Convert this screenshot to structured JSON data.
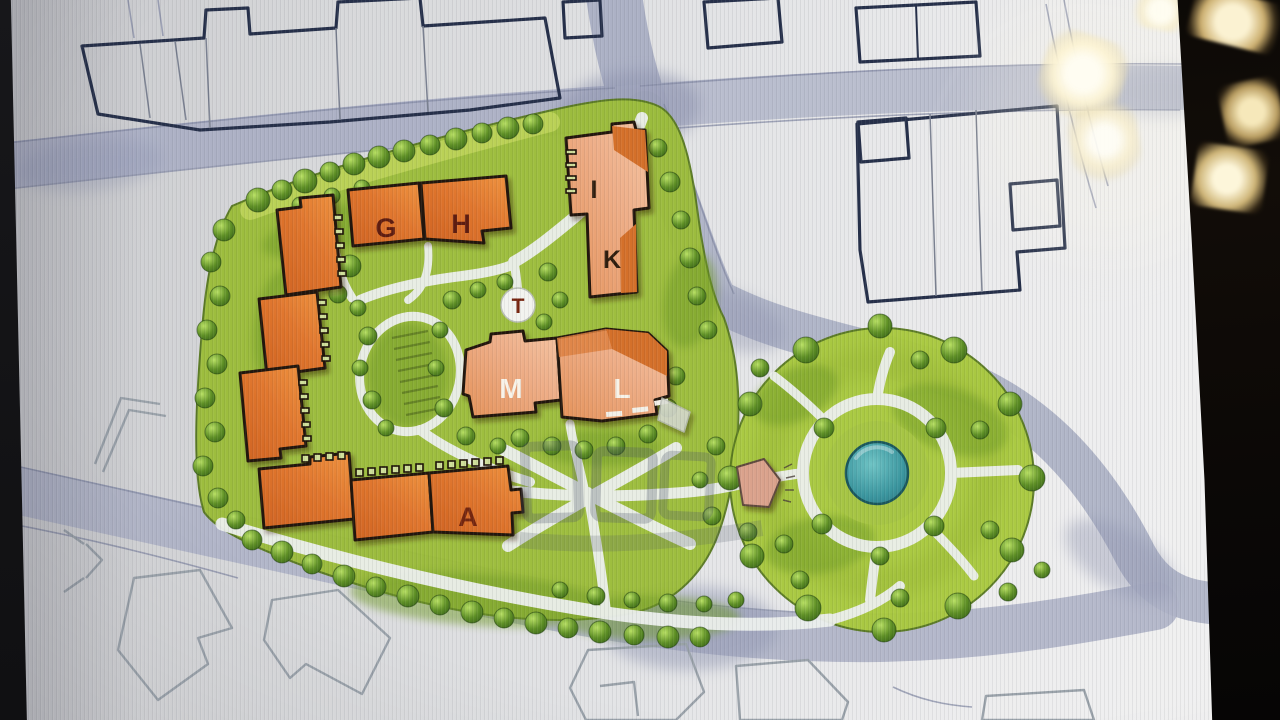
{
  "site_plan": {
    "building_labels": [
      {
        "id": "g",
        "label": "G",
        "color": "#5f1d10"
      },
      {
        "id": "h",
        "label": "H",
        "color": "#5f1d10"
      },
      {
        "id": "i",
        "label": "I",
        "color": "#2e1d0e"
      },
      {
        "id": "k",
        "label": "K",
        "color": "#2e1d0e"
      },
      {
        "id": "m",
        "label": "M",
        "color": "#f8f3e9"
      },
      {
        "id": "l",
        "label": "L",
        "color": "#f8f3e9"
      },
      {
        "id": "a",
        "label": "A",
        "color": "#74260f"
      },
      {
        "id": "t",
        "label": "T",
        "color": "#74220d"
      }
    ],
    "colors": {
      "paper": "#e3e4e6",
      "road": "#a9aec3",
      "road_wash_dark": "#8f94b0",
      "context_outline_bold": "#26304a",
      "context_outline_light": "#9aa2aa",
      "parcel_green": "#9cbd3a",
      "lawn_light": "#c2d65c",
      "green_dark_patch": "#6f9a26",
      "tree_dark": "#2f5a14",
      "tree_light": "#b8e063",
      "building_orange": "#e0762e",
      "building_salmon": "#eeae88",
      "building_dark_orange": "#d4702c",
      "building_pink": "#daa28c",
      "building_outline": "#241708",
      "path_light": "#edf0ee",
      "pond_teal": "#3795a5",
      "pond_edge": "#14525e",
      "watermark_gray": "#4e5568",
      "offscreen_black": "#0b0806",
      "flare_warm": "#f8eecb"
    }
  }
}
